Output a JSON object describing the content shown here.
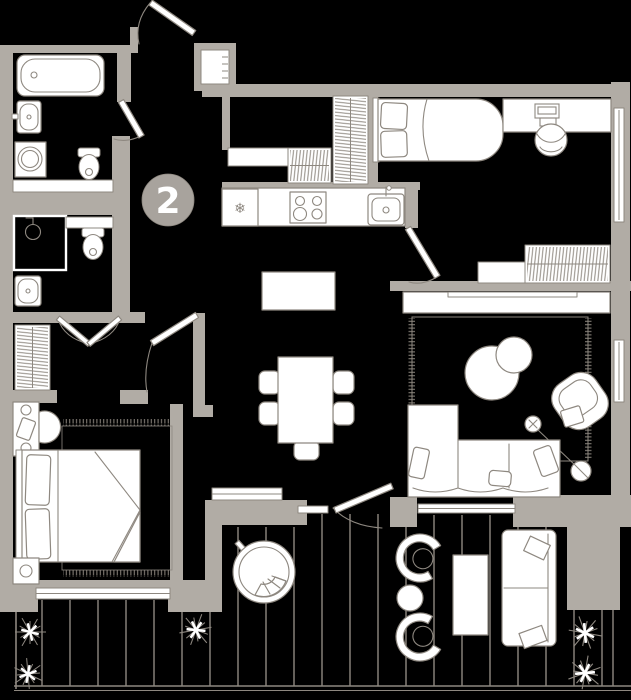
{
  "plan": {
    "unit_label": "2"
  },
  "icons": {
    "snowflake": "❄"
  },
  "colors": {
    "background": "#000000",
    "wall": "#b1aca5",
    "line": "#8e8880",
    "fill": "#ffffff",
    "marker": "#a8a39d",
    "marker_text": "#ffffff"
  }
}
